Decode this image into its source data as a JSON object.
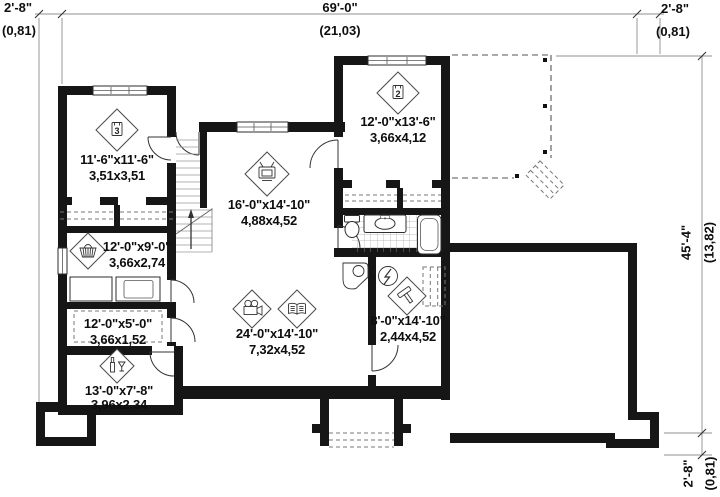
{
  "title": "basement floor plan",
  "colors": {
    "wall": "#161616",
    "background": "#ffffff",
    "dim_line": "#8f8f8f",
    "line": "#333333"
  },
  "dims": {
    "top_left_ft": "2'-8\"",
    "top_left_m": "(0,81)",
    "top_ft": "69'-0\"",
    "top_m": "(21,03)",
    "top_right_ft": "2'-8\"",
    "top_right_m": "(0,81)",
    "right_ft": "45'-4\"",
    "right_m": "(13,82)",
    "bottom_right_ft": "2'-8\"",
    "bottom_right_m": "(0,81)"
  },
  "rooms": [
    {
      "name": "bedroom-3",
      "ft": "11'-6\"x11'-6\"",
      "m": "3,51x3,51",
      "marker": "3",
      "icon": "room-number-badge"
    },
    {
      "name": "bedroom-2",
      "ft": "12'-0\"x13'-6\"",
      "m": "3,66x4,12",
      "marker": "2",
      "icon": "room-number-badge"
    },
    {
      "name": "family-room",
      "ft": "16'-0\"x14'-10\"",
      "m": "4,88x4,52",
      "icon": "tv-icon"
    },
    {
      "name": "laundry-room",
      "ft": "12'-0\"x9'-0\"",
      "m": "3,66x2,74",
      "icon": "laundry-basket-icon"
    },
    {
      "name": "storage",
      "ft": "12'-0\"x5'-0\"",
      "m": "3,66x1,52"
    },
    {
      "name": "cellar",
      "ft": "13'-0\"x7'-8\"",
      "m": "3,96x2,34",
      "icon": "wine-cellar-icon"
    },
    {
      "name": "rec-room",
      "ft": "24'-0\"x14'-10\"",
      "m": "7,32x4,52",
      "icons": [
        "projector-icon",
        "book-icon"
      ]
    },
    {
      "name": "workshop",
      "ft": "8'-0\"x14'-10\"",
      "m": "2,44x4,52",
      "icon": "hammer-icon"
    }
  ],
  "symbols": [
    "water-heater-icon",
    "electrical-panel-icon",
    "toilet",
    "sink-vanity",
    "bathtub",
    "washer",
    "dryer",
    "shelving",
    "stairs-up-arrow",
    "deck-dashed-outline",
    "deck-stairs",
    "window-well"
  ]
}
